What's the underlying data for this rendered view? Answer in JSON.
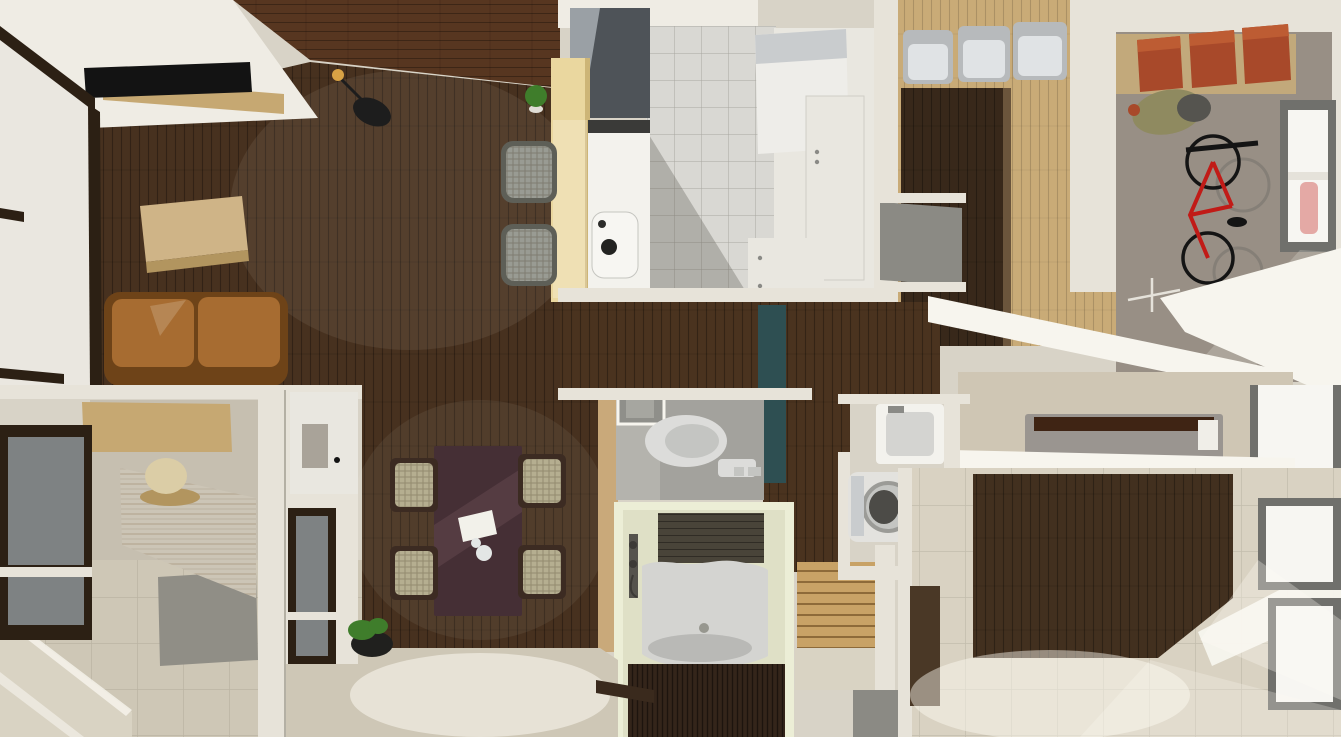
{
  "scene": {
    "view": "top-down-3d-apartment-render",
    "rooms": [
      {
        "name": "living-room",
        "items": [
          "tv",
          "tv-stand",
          "wall-guitar",
          "shoji-screens",
          "coffee-table",
          "sofa"
        ]
      },
      {
        "name": "balcony-deck",
        "items": [
          "potted-plant"
        ]
      },
      {
        "name": "kitchen",
        "items": [
          "range-hood",
          "island-counter",
          "sink",
          "bar-stool",
          "bar-stool",
          "refrigerator",
          "tall-cabinet",
          "base-cabinet",
          "potted-plant"
        ]
      },
      {
        "name": "closet-pantry",
        "items": [
          "wardrobe",
          "storage-bin",
          "storage-bin",
          "storage-bin",
          "stairwell-void"
        ]
      },
      {
        "name": "garage-entry",
        "items": [
          "shelf",
          "storage-box",
          "storage-box",
          "storage-box",
          "gear-bag",
          "bicycle",
          "window"
        ]
      },
      {
        "name": "entry-hall",
        "items": [
          "shoe-counter",
          "table-lamp",
          "floor-mat",
          "steps",
          "wall-cabinet",
          "interior-window",
          "potted-plant"
        ]
      },
      {
        "name": "dining-area",
        "items": [
          "dining-table",
          "dining-chair",
          "dining-chair",
          "dining-chair",
          "dining-chair",
          "potted-plant",
          "step-edge"
        ]
      },
      {
        "name": "toilet-room",
        "items": [
          "toilet",
          "vent-window",
          "tall-teal-cabinet"
        ]
      },
      {
        "name": "bathroom",
        "items": [
          "bathtub",
          "shower-fixture",
          "tiled-wall",
          "bath-mat"
        ]
      },
      {
        "name": "staircase",
        "items": [
          "wood-steps",
          "landing"
        ]
      },
      {
        "name": "laundry",
        "items": [
          "utility-sink",
          "washing-machine"
        ]
      },
      {
        "name": "bedroom",
        "items": [
          "planter-bed",
          "wood-floor",
          "carpet",
          "window",
          "window",
          "sunlight"
        ]
      }
    ]
  },
  "palette": {
    "canvas_bg": "#d8d3c7",
    "ceiling_white": "#efece4",
    "wall_white": "#e7e3d9",
    "wall_bright": "#f7f5ee",
    "wall_shadow": "#b4b0a4",
    "deck_wood": "#573620",
    "living_floor": "#47311f",
    "shoji_panel": "#eae7e0",
    "shoji_frame": "#2c2014",
    "tv_black": "#131313",
    "shelf_wood": "#c6a872",
    "coffee_table": "#cfb487",
    "coffee_table_side": "#b2955f",
    "sofa": "#a76c31",
    "sofa_dark": "#6e4318",
    "guitar_black": "#1d1d1d",
    "guitar_head": "#d8a245",
    "counter_wood": "#ead79f",
    "counter_wood_side": "#cdb577",
    "counter_white": "#f3f2ed",
    "stove_black": "#3a3a38",
    "hood_dark": "#4e5358",
    "hood_light": "#9aa0a5",
    "stool_gray": "#999b93",
    "stool_dark": "#5e5f57",
    "marble_floor": "#d9d8d3",
    "fridge_white": "#eeede9",
    "fridge_top": "#c9ccce",
    "cabinet_white": "#e9e7e0",
    "handle_gray": "#8a8a86",
    "plant_green": "#3f7d2b",
    "pot_white": "#e0ddd6",
    "pot_black": "#20201e",
    "closet_floor": "#c9ab77",
    "wardrobe_dark": "#38281a",
    "wardrobe_edge": "#6b553c",
    "bin_silver": "#b7babc",
    "bin_silver_light": "#e0e3e5",
    "void_gray": "#8b8a84",
    "garage_floor": "#988f85",
    "shelf_tan": "#c2a97b",
    "box_red": "#a8492a",
    "box_red_light": "#bd5c33",
    "bike_red": "#c11b17",
    "bike_black": "#141414",
    "bike_shadow": "#76736c",
    "stand_white": "#e5e2da",
    "bag_olive": "#8f8a60",
    "bag_gray": "#55544f",
    "window_frame": "#70706c",
    "glass_white": "#f7f6f2",
    "glass_gray": "#7e8283",
    "hall_floor": "#4a331f",
    "toilet_floor": "#a3a29d",
    "toilet_floor_light": "#b4b3ad",
    "toilet_white": "#dcdcda",
    "toilet_seat": "#c4c5c2",
    "vent_gray": "#8f8f8a",
    "vent_inner": "#a6a6a0",
    "teal_door": "#2e4f52",
    "wood_pillar": "#c9a97a",
    "bath_frame": "#eceed6",
    "bath_wall": "#dfe0c6",
    "bath_tile": "#494439",
    "tub_white": "#d4d4d1",
    "tub_shadow": "#b2b2af",
    "fixture_dark": "#55534d",
    "shower_dark": "#3c3a36",
    "drain_gray": "#97978f",
    "bath_mat": "#34251a",
    "stairs_wood": "#c8a266",
    "landing": "#d9d3c3",
    "washer_white": "#e3e2de",
    "washer_ring": "#9b9b97",
    "washer_lid": "#4c4b47",
    "bed_box_gray": "#9a9590",
    "bed_blanket": "#3f2414",
    "bedroom_floor": "#42301f",
    "carpet": "#d9d2c2",
    "taupe_floor": "#cfc6b4",
    "doorway_dark": "#4a3826",
    "entry_floor": "#cec7b6",
    "entry_floor_upper": "#c6bfb0",
    "entry_mat": "#908e86",
    "whitewash": "#ccc5b6",
    "lamp_cream": "#dbcda6",
    "dining_table": "#452f35",
    "dining_table_light": "#5d4148",
    "paper_white": "#f2f1ea",
    "teapot_white": "#e3e6e5",
    "chair_wicker": "#b5ae90",
    "chair_frame": "#3c2b22",
    "step_dark": "#3a2a1d",
    "sun_glow": "#fffdf5",
    "shadow_dark": "#54504a",
    "sink_bowl": "#232321",
    "faucet_dark": "#2c2c2a",
    "pillow_white": "#f0eee8",
    "cabinet_window": "#a9a399"
  }
}
